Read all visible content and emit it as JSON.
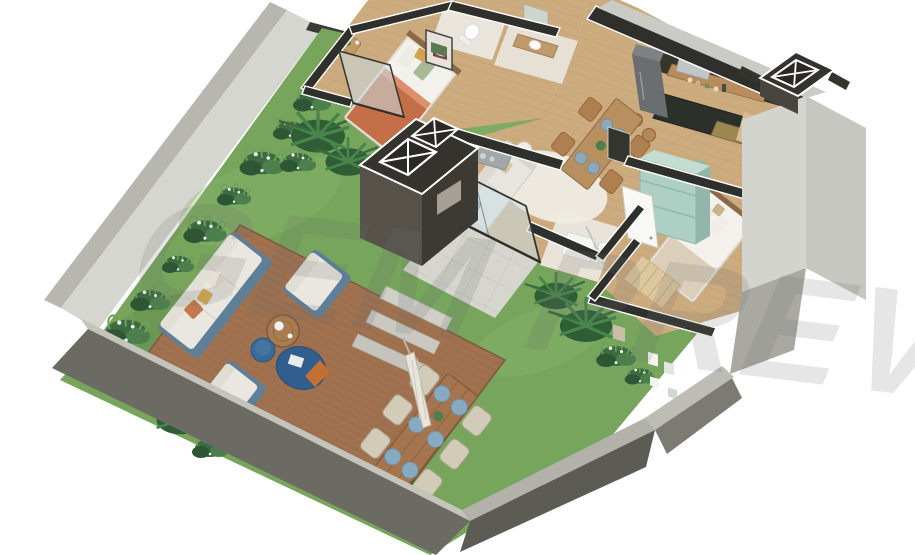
{
  "watermark": {
    "text": "GEM PREVI",
    "color": "#6f6f6f",
    "opacity": "0.17"
  },
  "scene": {
    "type": "isometric-3d-floor-plan-render",
    "rooms": [
      "garden-terrace",
      "wood-deck",
      "patio",
      "living-room",
      "dining-area",
      "kitchen",
      "hallway",
      "bedroom-1",
      "bathroom-1",
      "bathroom-2",
      "shower-room",
      "bedroom-2"
    ],
    "outdoor_objects": [
      "outdoor-sofa",
      "armchairs",
      "round-coffee-table",
      "blue-poufs",
      "outdoor-dining-table-for-6",
      "closed-patio-umbrella",
      "stepping-stones",
      "planting-beds",
      "boundary-walls",
      "ventilation-shafts"
    ],
    "indoor_objects": [
      "double-bed",
      "wall-art",
      "nightstand",
      "toilet",
      "washbasins",
      "vanity",
      "kitchen-counter",
      "gold-sink",
      "refrigerator",
      "microwave",
      "open-shelf",
      "bar-stools",
      "dining-table-for-4",
      "cream-sofa",
      "round-rug",
      "single-bed",
      "runner-rug",
      "mint-linen-wardrobe",
      "shower-tray",
      "glass-sliding-doors"
    ]
  },
  "colors": {
    "background": "#ffffff",
    "grass": "#76a55b",
    "deck": "#a0714f",
    "floor": "#ccab7e",
    "wallLight": "#d6d6d0",
    "wallMid": "#a9a9a2",
    "wallDark": "#6b6b64",
    "cutWall": "#2f2f2b",
    "glass": "rgba(202,222,228,0.55)",
    "accentBlue": "#5d7f98",
    "poufBlue": "#305e8f",
    "terracotta": "#c46f48",
    "mint": "#aecfc3",
    "counter": "#2c302a",
    "plate": "#85aac2",
    "paver": "#d6d6cf",
    "umbrella": "#e9e5da"
  }
}
